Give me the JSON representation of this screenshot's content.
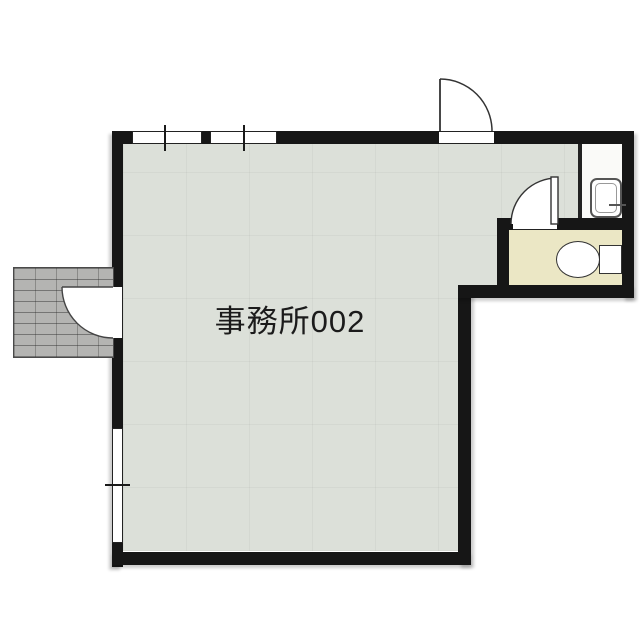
{
  "room": {
    "label": "事務所002"
  },
  "colors": {
    "page_bg": "#ffffff",
    "wall": "#161616",
    "main_floor": "#dce0d9",
    "wc_floor": "#ebe7c5",
    "niche_floor": "#fafaf8",
    "porch_tile": "#b4b4b2",
    "line": "#333333"
  },
  "fixtures": [
    {
      "name": "top-entrance-door",
      "kind": "outward swing door"
    },
    {
      "name": "left-entrance-door",
      "kind": "outward swing door"
    },
    {
      "name": "wc-door",
      "kind": "inward swing door"
    },
    {
      "name": "toilet",
      "kind": "toilet bowl with tank"
    },
    {
      "name": "hand-wash-sink",
      "kind": "small basin with faucet"
    },
    {
      "name": "window-top-left",
      "kind": "window"
    },
    {
      "name": "window-top-right",
      "kind": "window"
    },
    {
      "name": "window-left",
      "kind": "window"
    },
    {
      "name": "entrance-porch",
      "kind": "tiled step"
    }
  ]
}
